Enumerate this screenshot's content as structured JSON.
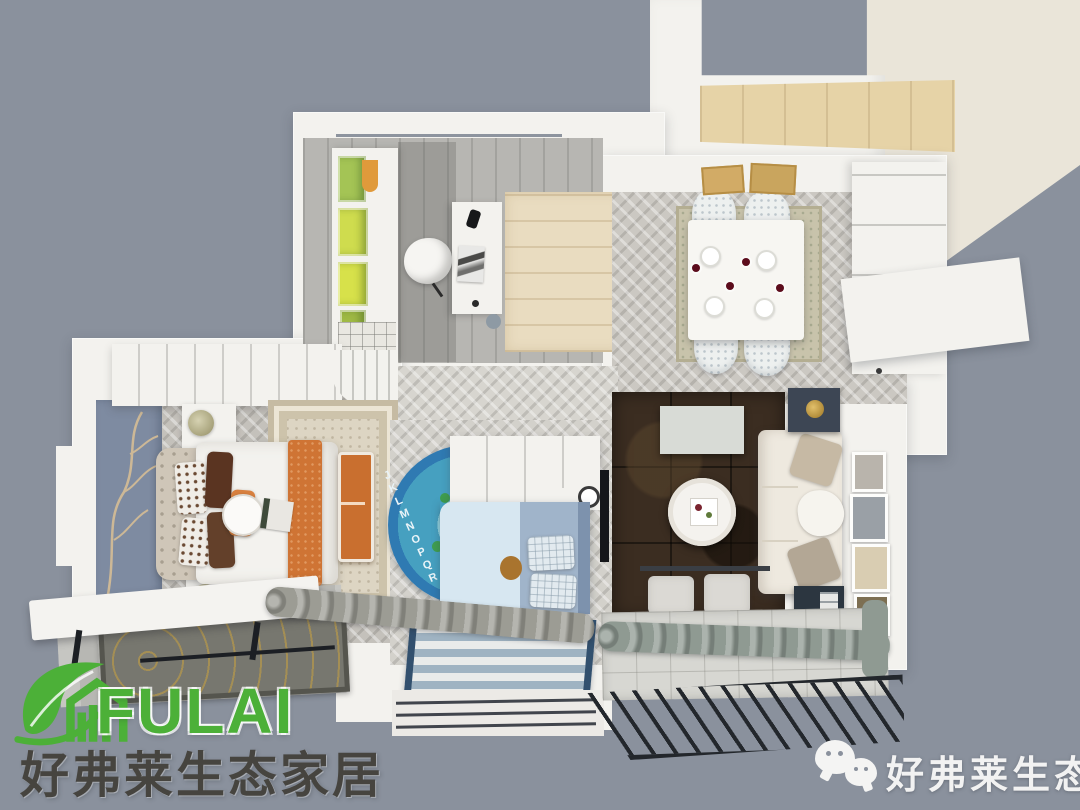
{
  "branding": {
    "logo_text": "FULAI",
    "tagline": "好弗莱生态家居"
  },
  "watermark": {
    "icon": "wechat-icon",
    "text": "好弗莱生态家居"
  },
  "scene": {
    "description_visible_text_only": true,
    "kids_rug_letters": "JKLMNOPQR"
  },
  "colors": {
    "bg": "#8a919d",
    "wallwhite": "#f3f2ee",
    "cream": "#eae5d9",
    "wood": "#e6d3a7",
    "woodroom": "#e9dcc0",
    "accentwall": "#7e8ba1",
    "rugbeige": "#ddd5c3",
    "orange": "#cf7434",
    "darkrug": "#3b2d21",
    "sofacream": "#eee9df",
    "bluerugouter": "#2f7ab2",
    "blueruginner": "#46a0c0",
    "kidbed": "#d7e7f1",
    "kidblanket": "#a0b4ca",
    "stripedark": "#32506e",
    "tile": "#d7d7d2",
    "curtain": "#8f9a92",
    "railing": "#23272c",
    "green": "#4cb038",
    "darktext": "#46443f",
    "watermarktext": "#f2f2f2"
  }
}
